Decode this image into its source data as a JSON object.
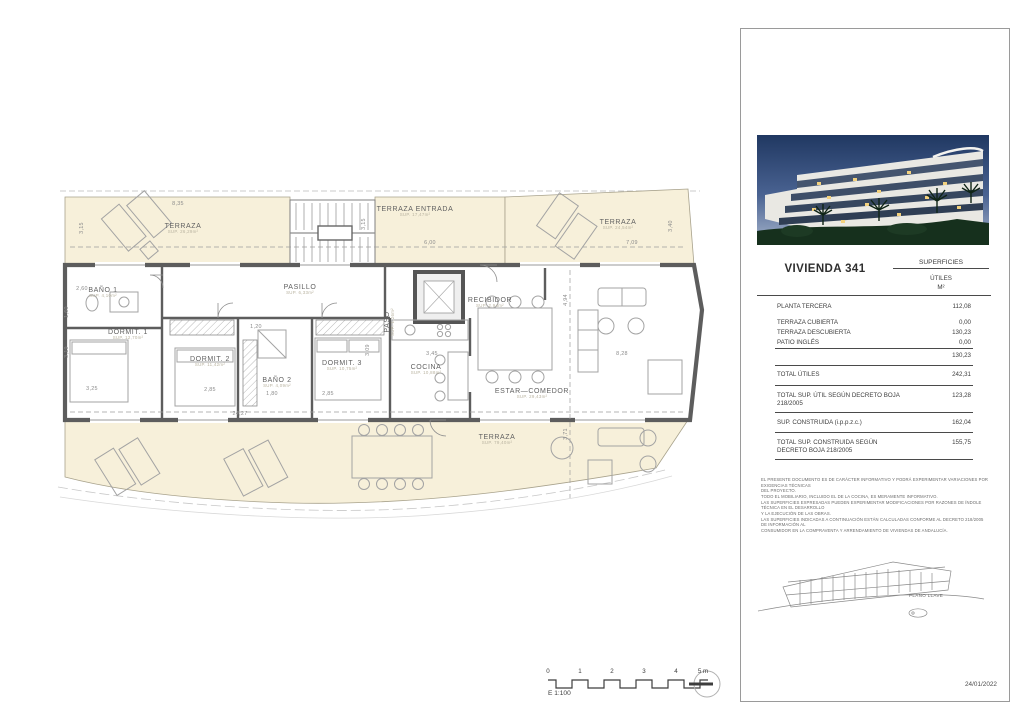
{
  "sheet": {
    "date": "24/01/2022",
    "scale": {
      "label": "E 1:100",
      "ticks": [
        "0",
        "1",
        "2",
        "3",
        "4",
        "5 m"
      ]
    }
  },
  "panel": {
    "title": "VIVIENDA 341",
    "surfaces_header": "SUPERFICIES",
    "surfaces_sub1": "ÚTILES",
    "surfaces_sub2": "M²",
    "rows": {
      "planta": {
        "label": "PLANTA TERCERA",
        "value": "112,08"
      },
      "terraza_cubierta": {
        "label": "TERRAZA CUBIERTA",
        "value": "0,00"
      },
      "terraza_descubierta": {
        "label": "TERRAZA DESCUBIERTA",
        "value": "130,23"
      },
      "patio_ingles": {
        "label": "PATIO INGLÉS",
        "value": "0,00"
      },
      "subtotal": {
        "label": "",
        "value": "130,23"
      },
      "total_utiles": {
        "label": "TOTAL ÚTILES",
        "value": "242,31"
      },
      "total_util_decreto": {
        "label": "TOTAL SUP. ÚTIL SEGÚN DECRETO BOJA 218/2005",
        "value": "123,28"
      },
      "construida": {
        "label": "SUP. CONSTRUIDA (i.p.p.z.c.)",
        "value": "162,04"
      },
      "total_construida_decreto": {
        "label": "TOTAL SUP. CONSTRUIDA SEGÚN DECRETO BOJA 218/2005",
        "value": "155,75"
      }
    },
    "disclaimer": [
      "EL PRESENTE DOCUMENTO ES DE CARÁCTER INFORMATIVO Y PODRÁ EXPERIMENTAR VARIACIONES POR EXIGENCIAS TÉCNICAS",
      "DEL PROYECTO.",
      "TODO EL MOBILIARIO, INCLUIDO EL DE LA COCINA, ES MERAMENTE INFORMATIVO.",
      "LAS SUPERFICIES EXPRESADAS PUEDEN EXPERIMENTAR MODIFICACIONES POR RAZONES DE ÍNDOLE TÉCNICA EN EL DESARROLLO",
      "Y LA EJECUCIÓN DE LAS OBRAS.",
      "LAS SUPERFICIES INDICADAS A CONTINUACIÓN ESTÁN CALCULADAS CONFORME AL DECRETO 218/2005 DE INFORMACIÓN AL",
      "CONSUMIDOR EN LA COMPRAVENTA Y ARRENDAMIENTO DE VIVIENDAS DE ANDALUCÍA."
    ],
    "keyplan_label": "PLANO LLAVE"
  },
  "floorplan": {
    "rooms": [
      {
        "name": "TERRAZA",
        "sup": "SUP. 26,29m²"
      },
      {
        "name": "TERRAZA ENTRADA",
        "sup": "SUP. 17,47m²"
      },
      {
        "name": "TERRAZA",
        "sup": "SUP. 24,54m²"
      },
      {
        "name": "BAÑO 1",
        "sup": "SUP. 4,10m²"
      },
      {
        "name": "PASILLO",
        "sup": "SUP. 6,33m²"
      },
      {
        "name": "PASO",
        "sup": "SUP. 1,26m²"
      },
      {
        "name": "RECIBIDOR",
        "sup": "SUP. 2,94m²"
      },
      {
        "name": "DORMIT. 1",
        "sup": "SUP. 12,70m²"
      },
      {
        "name": "DORMIT. 2",
        "sup": "SUP. 11,42m²"
      },
      {
        "name": "BAÑO 2",
        "sup": "SUP. 4,09m²"
      },
      {
        "name": "DORMIT. 3",
        "sup": "SUP. 10,75m²"
      },
      {
        "name": "COCINA",
        "sup": "SUP. 10,88m²"
      },
      {
        "name": "ESTAR—COMEDOR",
        "sup": "SUP. 29,43m²"
      },
      {
        "name": "TERRAZA",
        "sup": "SUP. 79,40m²"
      }
    ],
    "dims": [
      "8,35",
      "3,15",
      "3,15",
      "6,00",
      "7,09",
      "3,40",
      "2,60",
      "1,60",
      "3,19",
      "3,25",
      "2,85",
      "1,80",
      "2,85",
      "3,09",
      "1,20",
      "24,27",
      "3,45",
      "8,28",
      "4,94",
      "3,71"
    ]
  }
}
